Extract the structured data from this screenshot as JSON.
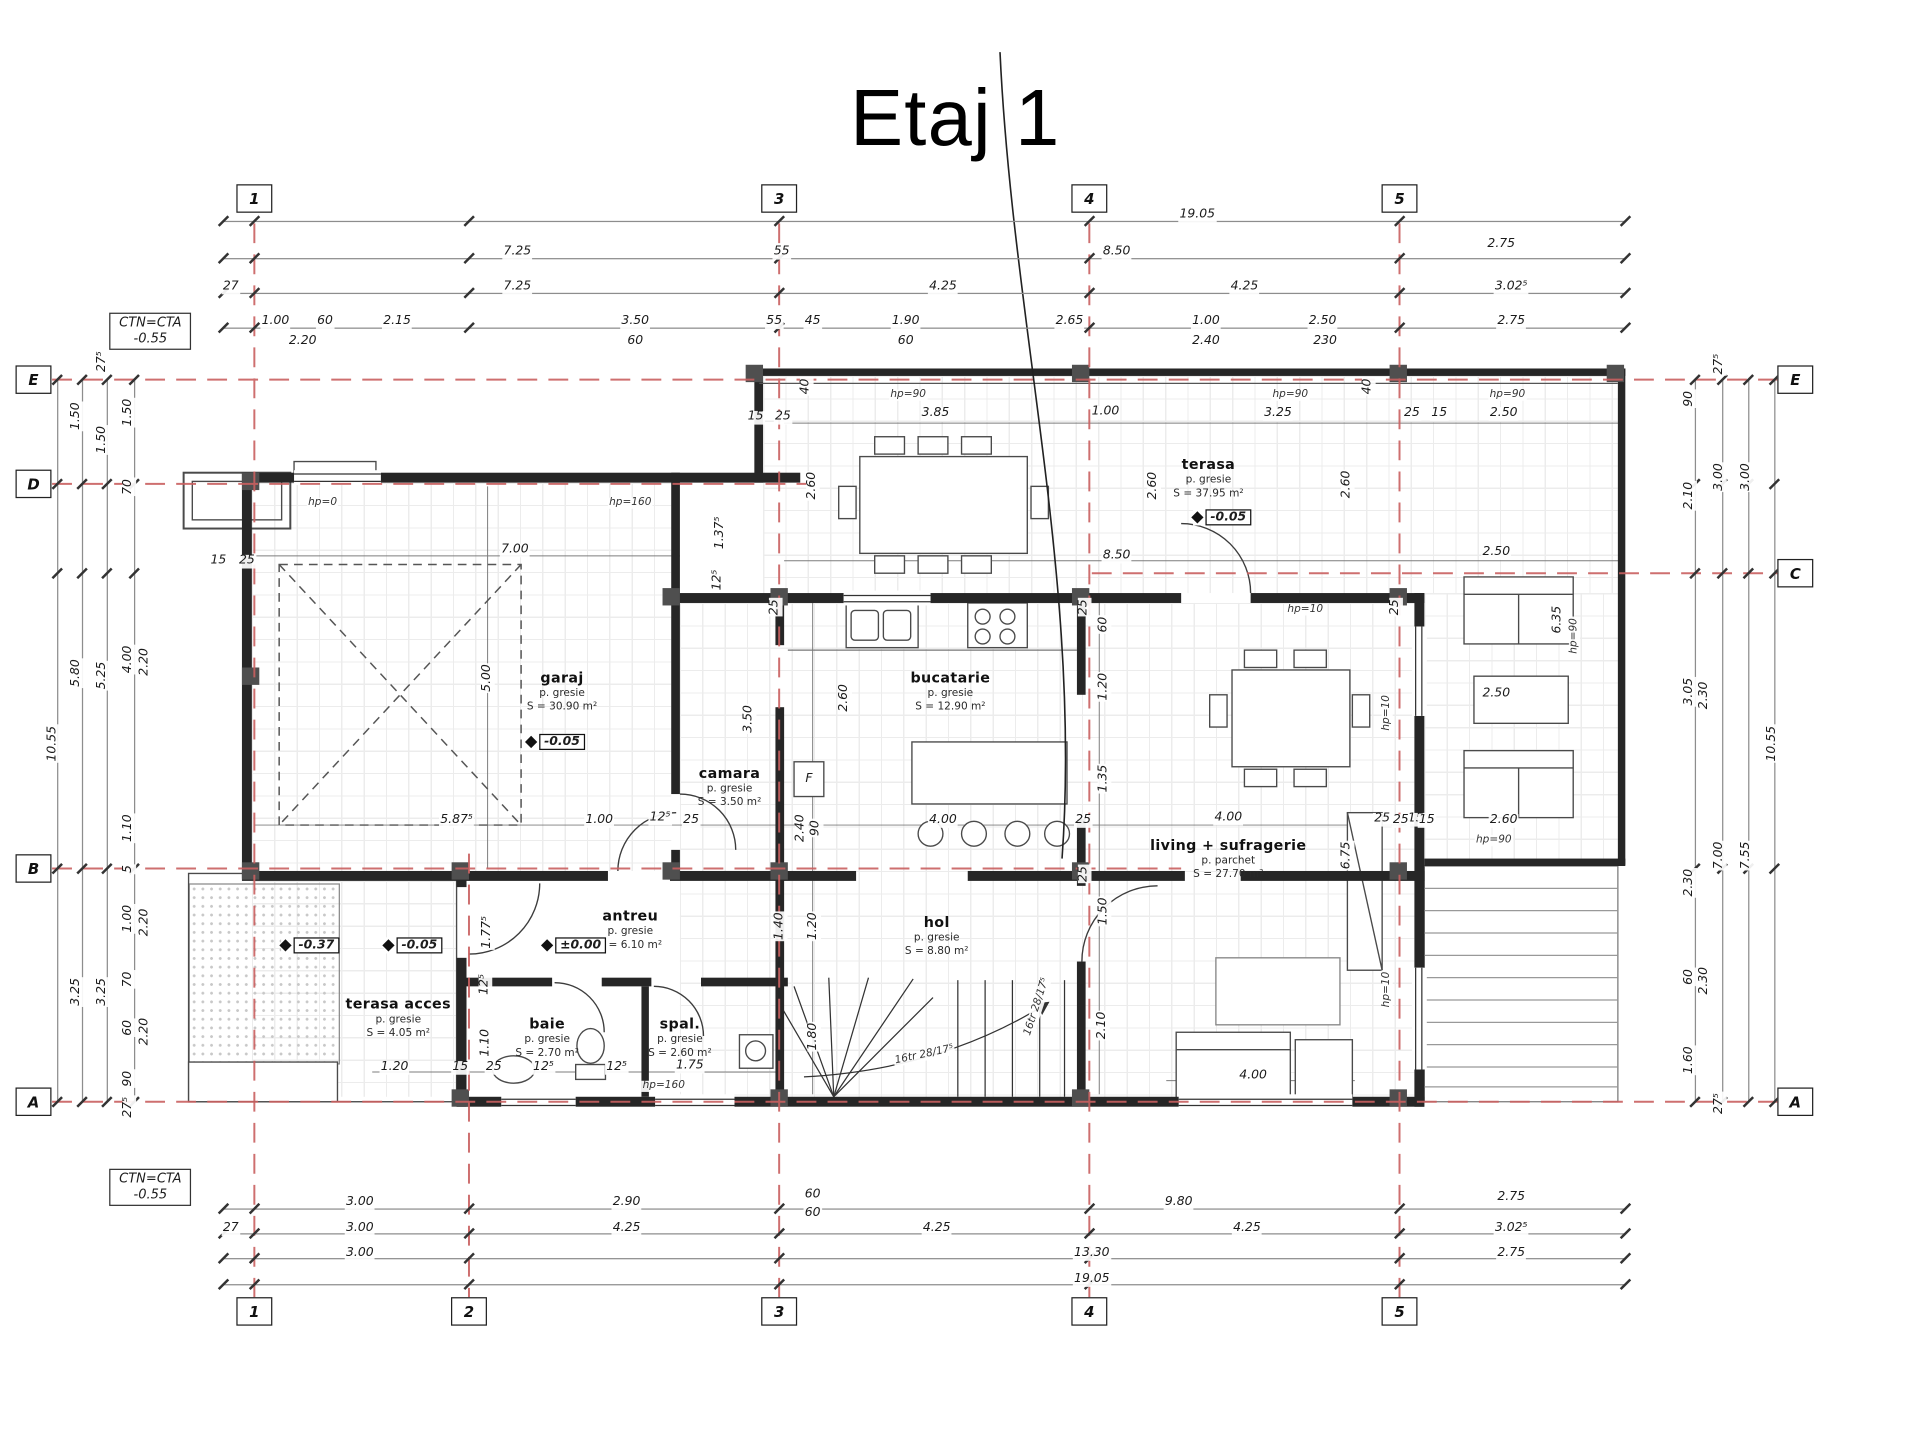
{
  "title": "Etaj 1",
  "notes": {
    "top": {
      "l1": "CTN=CTA",
      "l2": "-0.55"
    },
    "bottom": {
      "l1": "CTN=CTA",
      "l2": "-0.55"
    }
  },
  "grid": {
    "axis_color": "#c96060",
    "bubbles_top": {
      "y": 160,
      "items": [
        {
          "t": "1",
          "x": 205
        },
        {
          "t": "3",
          "x": 628
        },
        {
          "t": "4",
          "x": 878
        },
        {
          "t": "5",
          "x": 1128
        }
      ]
    },
    "bubbles_bottom": {
      "y": 1057,
      "items": [
        {
          "t": "1",
          "x": 205
        },
        {
          "t": "2",
          "x": 378
        },
        {
          "t": "3",
          "x": 628
        },
        {
          "t": "4",
          "x": 878
        },
        {
          "t": "5",
          "x": 1128
        }
      ]
    },
    "bubbles_left": {
      "x": 27,
      "items": [
        {
          "t": "E",
          "y": 306
        },
        {
          "t": "D",
          "y": 390
        },
        {
          "t": "B",
          "y": 700
        },
        {
          "t": "A",
          "y": 888
        }
      ]
    },
    "bubbles_right": {
      "x": 1447,
      "items": [
        {
          "t": "E",
          "y": 306
        },
        {
          "t": "C",
          "y": 462
        },
        {
          "t": "A",
          "y": 888
        }
      ]
    }
  },
  "lines": {
    "h": [
      {
        "y": 178,
        "x1": 180,
        "x2": 1310
      },
      {
        "y": 208,
        "x1": 180,
        "x2": 1310
      },
      {
        "y": 236,
        "x1": 180,
        "x2": 1310
      },
      {
        "y": 264,
        "x1": 180,
        "x2": 1310
      },
      {
        "y": 974,
        "x1": 180,
        "x2": 1310
      },
      {
        "y": 994,
        "x1": 180,
        "x2": 1310
      },
      {
        "y": 1014,
        "x1": 180,
        "x2": 1310
      },
      {
        "y": 1035,
        "x1": 180,
        "x2": 1310
      }
    ],
    "ticks_h": [
      180,
      205,
      378,
      628,
      878,
      1128,
      1310
    ],
    "v": [
      {
        "x": 46,
        "y1": 306,
        "y2": 888
      },
      {
        "x": 66,
        "y1": 306,
        "y2": 888
      },
      {
        "x": 86,
        "y1": 306,
        "y2": 888
      },
      {
        "x": 108,
        "y1": 306,
        "y2": 888
      },
      {
        "x": 1366,
        "y1": 306,
        "y2": 888
      },
      {
        "x": 1388,
        "y1": 306,
        "y2": 888
      },
      {
        "x": 1409,
        "y1": 306,
        "y2": 888
      },
      {
        "x": 1430,
        "y1": 306,
        "y2": 888
      }
    ],
    "ticks_v": [
      306,
      390,
      462,
      700,
      888
    ]
  },
  "labels": [
    {
      "t": "19.05",
      "x": 965,
      "y": 174
    },
    {
      "t": "7.25",
      "x": 417,
      "y": 204
    },
    {
      "t": "55",
      "x": 630,
      "y": 204
    },
    {
      "t": "8.50",
      "x": 900,
      "y": 204
    },
    {
      "t": "2.75",
      "x": 1210,
      "y": 198
    },
    {
      "t": "27",
      "x": 186,
      "y": 232
    },
    {
      "t": "7.25",
      "x": 417,
      "y": 232
    },
    {
      "t": "4.25",
      "x": 760,
      "y": 232
    },
    {
      "t": "4.25",
      "x": 1003,
      "y": 232
    },
    {
      "t": "3.02⁵",
      "x": 1218,
      "y": 232
    },
    {
      "t": "1.00",
      "x": 222,
      "y": 260
    },
    {
      "t": "60",
      "x": 262,
      "y": 260
    },
    {
      "t": "2.15",
      "x": 320,
      "y": 260
    },
    {
      "t": "3.50",
      "x": 512,
      "y": 260
    },
    {
      "t": "55",
      "x": 624,
      "y": 260
    },
    {
      "t": "45",
      "x": 655,
      "y": 260
    },
    {
      "t": "1.90",
      "x": 730,
      "y": 260
    },
    {
      "t": "2.65",
      "x": 862,
      "y": 260
    },
    {
      "t": "1.00",
      "x": 972,
      "y": 260
    },
    {
      "t": "2.50",
      "x": 1066,
      "y": 260
    },
    {
      "t": "2.75",
      "x": 1218,
      "y": 260
    },
    {
      "t": "2.20",
      "x": 244,
      "y": 276
    },
    {
      "t": "60",
      "x": 512,
      "y": 276
    },
    {
      "t": "60",
      "x": 730,
      "y": 276
    },
    {
      "t": "2.40",
      "x": 972,
      "y": 276
    },
    {
      "t": "230",
      "x": 1068,
      "y": 276
    },
    {
      "t": "3.00",
      "x": 290,
      "y": 970
    },
    {
      "t": "2.90",
      "x": 505,
      "y": 970
    },
    {
      "t": "60",
      "x": 655,
      "y": 964
    },
    {
      "t": "60",
      "x": 655,
      "y": 979
    },
    {
      "t": "9.80",
      "x": 950,
      "y": 970
    },
    {
      "t": "2.75",
      "x": 1218,
      "y": 966
    },
    {
      "t": "27",
      "x": 186,
      "y": 991
    },
    {
      "t": "3.00",
      "x": 290,
      "y": 991
    },
    {
      "t": "4.25",
      "x": 505,
      "y": 991
    },
    {
      "t": "4.25",
      "x": 755,
      "y": 991
    },
    {
      "t": "4.25",
      "x": 1005,
      "y": 991
    },
    {
      "t": "3.02⁵",
      "x": 1218,
      "y": 991
    },
    {
      "t": "3.00",
      "x": 290,
      "y": 1011
    },
    {
      "t": "13.30",
      "x": 880,
      "y": 1011
    },
    {
      "t": "2.75",
      "x": 1218,
      "y": 1011
    },
    {
      "t": "19.05",
      "x": 880,
      "y": 1032
    },
    {
      "t": "10.55",
      "x": 43,
      "y": 600,
      "r": 1
    },
    {
      "t": "1.50",
      "x": 62,
      "y": 336,
      "r": 1
    },
    {
      "t": "5.80",
      "x": 62,
      "y": 543,
      "r": 1
    },
    {
      "t": "3.25",
      "x": 62,
      "y": 800,
      "r": 1
    },
    {
      "t": "27⁵",
      "x": 83,
      "y": 292,
      "r": 1
    },
    {
      "t": "1.50",
      "x": 83,
      "y": 355,
      "r": 1
    },
    {
      "t": "5.25",
      "x": 83,
      "y": 545,
      "r": 1
    },
    {
      "t": "3.25",
      "x": 83,
      "y": 800,
      "r": 1
    },
    {
      "t": "1.50",
      "x": 104,
      "y": 333,
      "r": 1
    },
    {
      "t": "70",
      "x": 104,
      "y": 393,
      "r": 1
    },
    {
      "t": "4.00",
      "x": 104,
      "y": 532,
      "r": 1
    },
    {
      "t": "1.10",
      "x": 104,
      "y": 668,
      "r": 1
    },
    {
      "t": "5",
      "x": 104,
      "y": 701,
      "r": 1
    },
    {
      "t": "1.00",
      "x": 104,
      "y": 741,
      "r": 1
    },
    {
      "t": "70",
      "x": 104,
      "y": 790,
      "r": 1
    },
    {
      "t": "60",
      "x": 104,
      "y": 829,
      "r": 1
    },
    {
      "t": "90",
      "x": 104,
      "y": 870,
      "r": 1
    },
    {
      "t": "27⁵",
      "x": 104,
      "y": 893,
      "r": 1
    },
    {
      "t": "2.20",
      "x": 117,
      "y": 534,
      "r": 1
    },
    {
      "t": "2.20",
      "x": 117,
      "y": 744,
      "r": 1
    },
    {
      "t": "2.20",
      "x": 117,
      "y": 832,
      "r": 1
    },
    {
      "t": "90",
      "x": 1362,
      "y": 322,
      "r": 1
    },
    {
      "t": "2.10",
      "x": 1362,
      "y": 400,
      "r": 1
    },
    {
      "t": "3.05",
      "x": 1362,
      "y": 558,
      "r": 1
    },
    {
      "t": "2.30",
      "x": 1362,
      "y": 712,
      "r": 1
    },
    {
      "t": "60",
      "x": 1362,
      "y": 788,
      "r": 1
    },
    {
      "t": "1.60",
      "x": 1362,
      "y": 855,
      "r": 1
    },
    {
      "t": "2.30",
      "x": 1374,
      "y": 561,
      "r": 1
    },
    {
      "t": "2.30",
      "x": 1374,
      "y": 791,
      "r": 1
    },
    {
      "t": "27⁵",
      "x": 1386,
      "y": 294,
      "r": 1
    },
    {
      "t": "3.00",
      "x": 1386,
      "y": 385,
      "r": 1
    },
    {
      "t": "7.00",
      "x": 1386,
      "y": 690,
      "r": 1
    },
    {
      "t": "27⁵",
      "x": 1386,
      "y": 890,
      "r": 1
    },
    {
      "t": "3.00",
      "x": 1408,
      "y": 385,
      "r": 1
    },
    {
      "t": "7.55",
      "x": 1408,
      "y": 690,
      "r": 1
    },
    {
      "t": "10.55",
      "x": 1429,
      "y": 600,
      "r": 1
    },
    {
      "t": "7.00",
      "x": 415,
      "y": 444
    },
    {
      "t": "5.00",
      "x": 393,
      "y": 547,
      "r": 1
    },
    {
      "t": "15",
      "x": 176,
      "y": 453
    },
    {
      "t": "25",
      "x": 199,
      "y": 453
    },
    {
      "t": "hp=0",
      "x": 260,
      "y": 406
    },
    {
      "t": "hp=160",
      "x": 508,
      "y": 406
    },
    {
      "t": "1.37⁵",
      "x": 581,
      "y": 430,
      "r": 1
    },
    {
      "t": "12⁵",
      "x": 579,
      "y": 468,
      "r": 1
    },
    {
      "t": "3.50",
      "x": 604,
      "y": 580,
      "r": 1
    },
    {
      "t": "2.60",
      "x": 681,
      "y": 563,
      "r": 1
    },
    {
      "t": "90",
      "x": 658,
      "y": 668,
      "r": 1
    },
    {
      "t": "2.40",
      "x": 646,
      "y": 668,
      "r": 1
    },
    {
      "t": "5.87⁵",
      "x": 368,
      "y": 662
    },
    {
      "t": "1.00",
      "x": 483,
      "y": 662
    },
    {
      "t": "12⁵",
      "x": 532,
      "y": 660
    },
    {
      "t": "25",
      "x": 557,
      "y": 662
    },
    {
      "t": "hp=90",
      "x": 732,
      "y": 319
    },
    {
      "t": "3.85",
      "x": 754,
      "y": 334
    },
    {
      "t": "1.00",
      "x": 891,
      "y": 333
    },
    {
      "t": "hp=90",
      "x": 1040,
      "y": 319
    },
    {
      "t": "3.25",
      "x": 1030,
      "y": 334
    },
    {
      "t": "hp=90",
      "x": 1215,
      "y": 319
    },
    {
      "t": "2.50",
      "x": 1212,
      "y": 334
    },
    {
      "t": "15",
      "x": 1160,
      "y": 334
    },
    {
      "t": "25",
      "x": 1138,
      "y": 334
    },
    {
      "t": "40",
      "x": 650,
      "y": 312,
      "r": 1
    },
    {
      "t": "40",
      "x": 1103,
      "y": 312,
      "r": 1
    },
    {
      "t": "15",
      "x": 609,
      "y": 337
    },
    {
      "t": "25",
      "x": 631,
      "y": 337
    },
    {
      "t": "2.60",
      "x": 655,
      "y": 392,
      "r": 1
    },
    {
      "t": "2.60",
      "x": 930,
      "y": 392,
      "r": 1
    },
    {
      "t": "2.60",
      "x": 1086,
      "y": 391,
      "r": 1
    },
    {
      "t": "8.50",
      "x": 900,
      "y": 449
    },
    {
      "t": "2.50",
      "x": 1206,
      "y": 446
    },
    {
      "t": "60",
      "x": 890,
      "y": 504,
      "r": 1
    },
    {
      "t": "1.20",
      "x": 890,
      "y": 554,
      "r": 1
    },
    {
      "t": "1.35",
      "x": 890,
      "y": 628,
      "r": 1
    },
    {
      "t": "hp=10",
      "x": 1052,
      "y": 492
    },
    {
      "t": "hp=10",
      "x": 1118,
      "y": 575,
      "r": 1
    },
    {
      "t": "hp=10",
      "x": 1118,
      "y": 798,
      "r": 1
    },
    {
      "t": "6.35",
      "x": 1256,
      "y": 500,
      "r": 1
    },
    {
      "t": "hp=90",
      "x": 1269,
      "y": 513,
      "r": 1
    },
    {
      "t": "4.00",
      "x": 760,
      "y": 662
    },
    {
      "t": "25",
      "x": 873,
      "y": 662
    },
    {
      "t": "4.00",
      "x": 990,
      "y": 660
    },
    {
      "t": "25",
      "x": 1114,
      "y": 661
    },
    {
      "t": "15",
      "x": 1141,
      "y": 661
    },
    {
      "t": "6.75",
      "x": 1086,
      "y": 690,
      "r": 1
    },
    {
      "t": "2.50",
      "x": 1206,
      "y": 560
    },
    {
      "t": "2.60",
      "x": 1212,
      "y": 662
    },
    {
      "t": "hp=90",
      "x": 1204,
      "y": 678
    },
    {
      "t": "15",
      "x": 1150,
      "y": 662
    },
    {
      "t": "25",
      "x": 1129,
      "y": 662
    },
    {
      "t": "25",
      "x": 625,
      "y": 490,
      "r": 1
    },
    {
      "t": "25",
      "x": 874,
      "y": 490,
      "r": 1
    },
    {
      "t": "25",
      "x": 1125,
      "y": 490,
      "r": 1
    },
    {
      "t": "25",
      "x": 874,
      "y": 705,
      "r": 1
    },
    {
      "t": "1.50",
      "x": 890,
      "y": 735,
      "r": 1
    },
    {
      "t": "2.10",
      "x": 889,
      "y": 827,
      "r": 1
    },
    {
      "t": "1.40",
      "x": 629,
      "y": 747,
      "r": 1
    },
    {
      "t": "1.20",
      "x": 656,
      "y": 747,
      "r": 1
    },
    {
      "t": "1.80",
      "x": 656,
      "y": 836,
      "r": 1
    },
    {
      "t": "16tr 28/17⁵",
      "x": 836,
      "y": 812,
      "d": -72
    },
    {
      "t": "16tr 28/17⁵",
      "x": 745,
      "y": 851,
      "d": -12
    },
    {
      "t": "1.77⁵",
      "x": 393,
      "y": 752,
      "r": 1
    },
    {
      "t": "12⁵",
      "x": 391,
      "y": 794,
      "r": 1
    },
    {
      "t": "1.10",
      "x": 392,
      "y": 841,
      "r": 1
    },
    {
      "t": "1.20",
      "x": 318,
      "y": 861
    },
    {
      "t": "15",
      "x": 371,
      "y": 861
    },
    {
      "t": "25",
      "x": 398,
      "y": 861
    },
    {
      "t": "12⁵",
      "x": 438,
      "y": 861
    },
    {
      "t": "12⁵",
      "x": 497,
      "y": 861
    },
    {
      "t": "1.75",
      "x": 556,
      "y": 860
    },
    {
      "t": "hp=160",
      "x": 535,
      "y": 876
    },
    {
      "t": "F",
      "x": 652,
      "y": 629
    },
    {
      "t": "4.00",
      "x": 1010,
      "y": 868
    }
  ],
  "rooms": [
    {
      "n": "garaj",
      "f": "p. gresie",
      "a": "S = 30.90 m²",
      "x": 453,
      "y": 557
    },
    {
      "n": "camara",
      "f": "p. gresie",
      "a": "S = 3.50 m²",
      "x": 588,
      "y": 634
    },
    {
      "n": "bucatarie",
      "f": "p. gresie",
      "a": "S = 12.90 m²",
      "x": 766,
      "y": 557
    },
    {
      "n": "terasa",
      "f": "p. gresie",
      "a": "S = 37.95 m²",
      "x": 974,
      "y": 385
    },
    {
      "n": "living + sufragerie",
      "f": "p. parchet",
      "a": "S = 27.70 m²",
      "x": 990,
      "y": 692
    },
    {
      "n": "hol",
      "f": "p. gresie",
      "a": "S = 8.80 m²",
      "x": 755,
      "y": 754
    },
    {
      "n": "antreu",
      "f": "p. gresie",
      "a": "S = 6.10 m²",
      "x": 508,
      "y": 749
    },
    {
      "n": "baie",
      "f": "p. gresie",
      "a": "S = 2.70 m²",
      "x": 441,
      "y": 836
    },
    {
      "n": "spal.",
      "f": "p. gresie",
      "a": "S = 2.60 m²",
      "x": 548,
      "y": 836
    },
    {
      "n": "terasa acces",
      "f": "p. gresie",
      "a": "S = 4.05 m²",
      "x": 321,
      "y": 820
    }
  ],
  "levels": [
    {
      "v": "-0.05",
      "x": 448,
      "y": 598
    },
    {
      "v": "-0.05",
      "x": 985,
      "y": 417
    },
    {
      "v": "±0.00",
      "x": 463,
      "y": 762
    },
    {
      "v": "-0.05",
      "x": 333,
      "y": 762
    },
    {
      "v": "-0.37",
      "x": 250,
      "y": 762
    }
  ]
}
